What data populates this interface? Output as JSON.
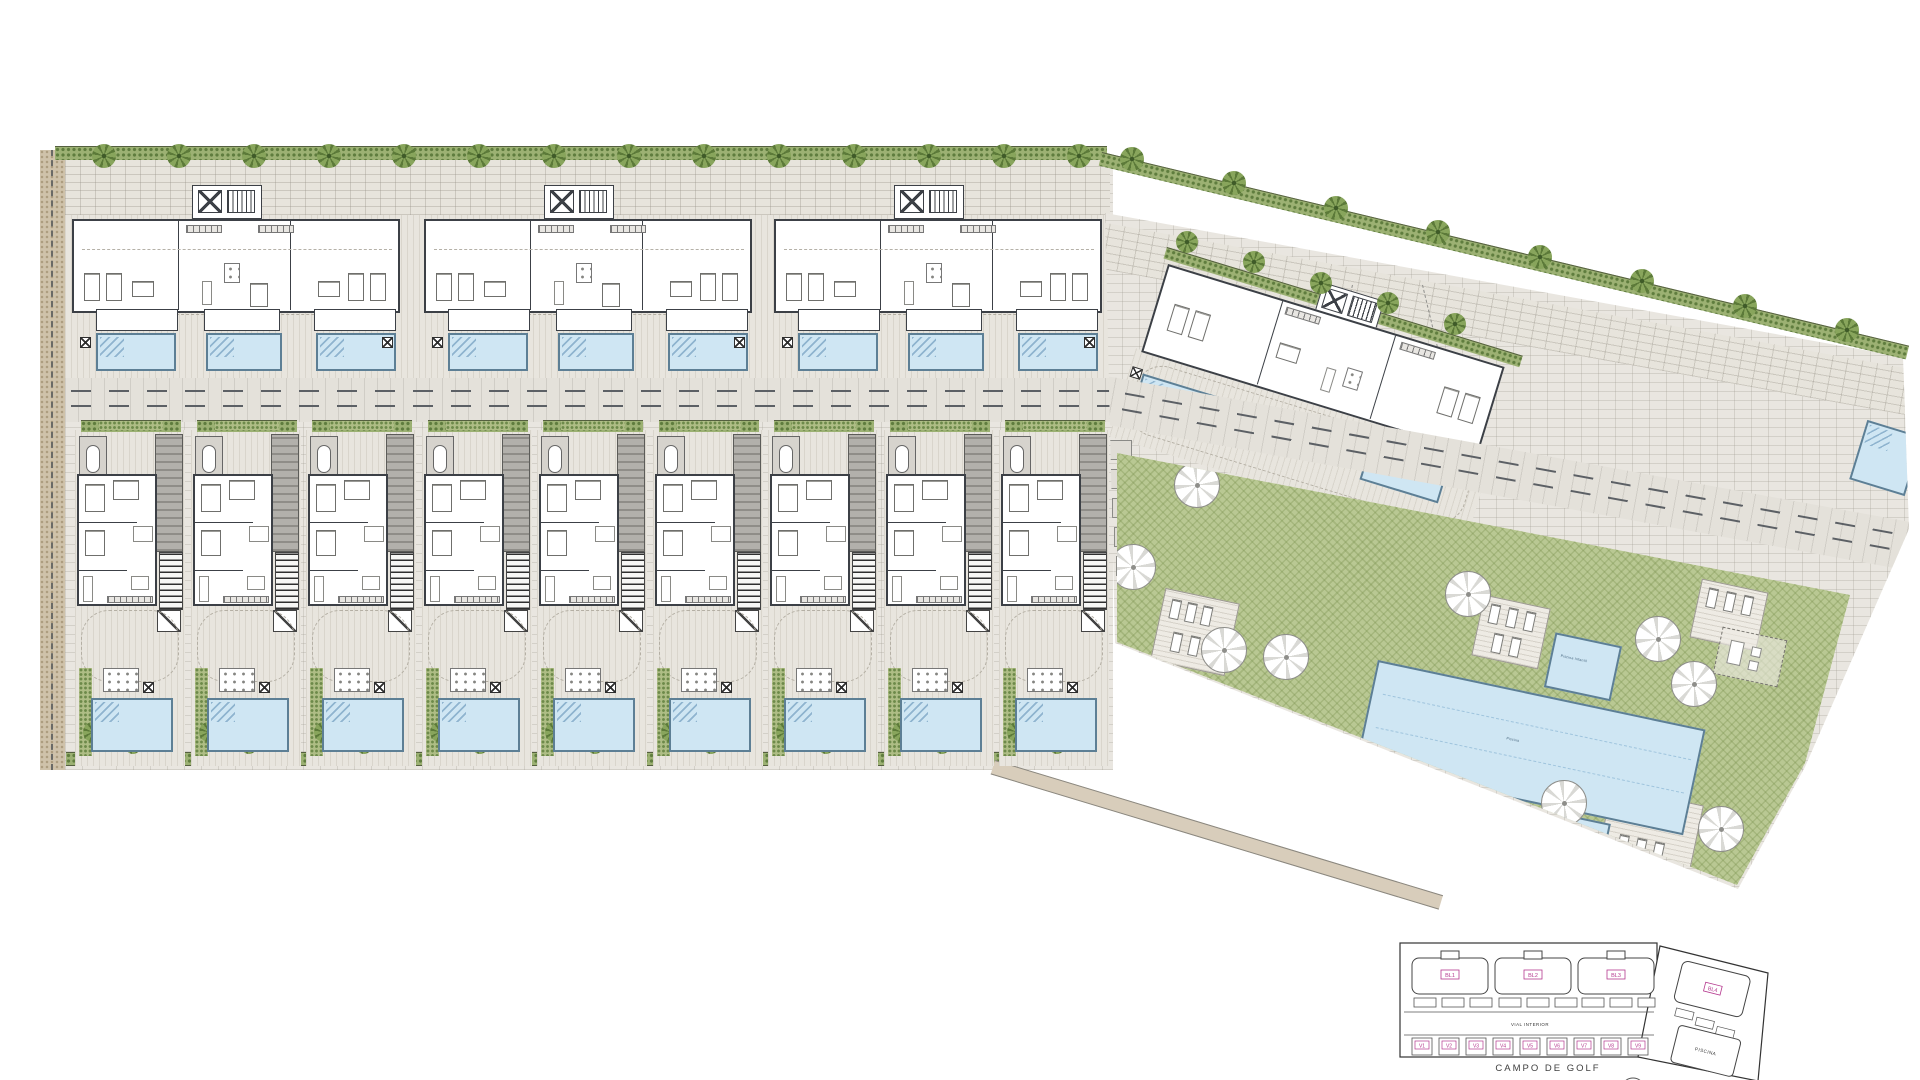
{
  "keyplan": {
    "block_labels": [
      "BL1",
      "BL2",
      "BL3",
      "BL4"
    ],
    "villa_labels": [
      "V1",
      "V2",
      "V3",
      "V4",
      "V5",
      "V6",
      "V7",
      "V8",
      "V9"
    ],
    "road_label": "VIAL INTERIOR",
    "pool_building_label": "PISCINA",
    "caption": "CAMPO DE GOLF"
  },
  "site": {
    "pool_labels": {
      "kids_pool": "Piscina Infantil",
      "main_pool": "Piscina",
      "jacuzzi": "Jacuzzi"
    }
  },
  "colors": {
    "pool_water": "#cfe6f3",
    "lawn": "#b9c893",
    "wall": "#3c4046",
    "hedge": "#9cb173",
    "paving": "#e9e6e0",
    "gravel": "#cfc2aa",
    "label_magenta": "#b5398f"
  }
}
